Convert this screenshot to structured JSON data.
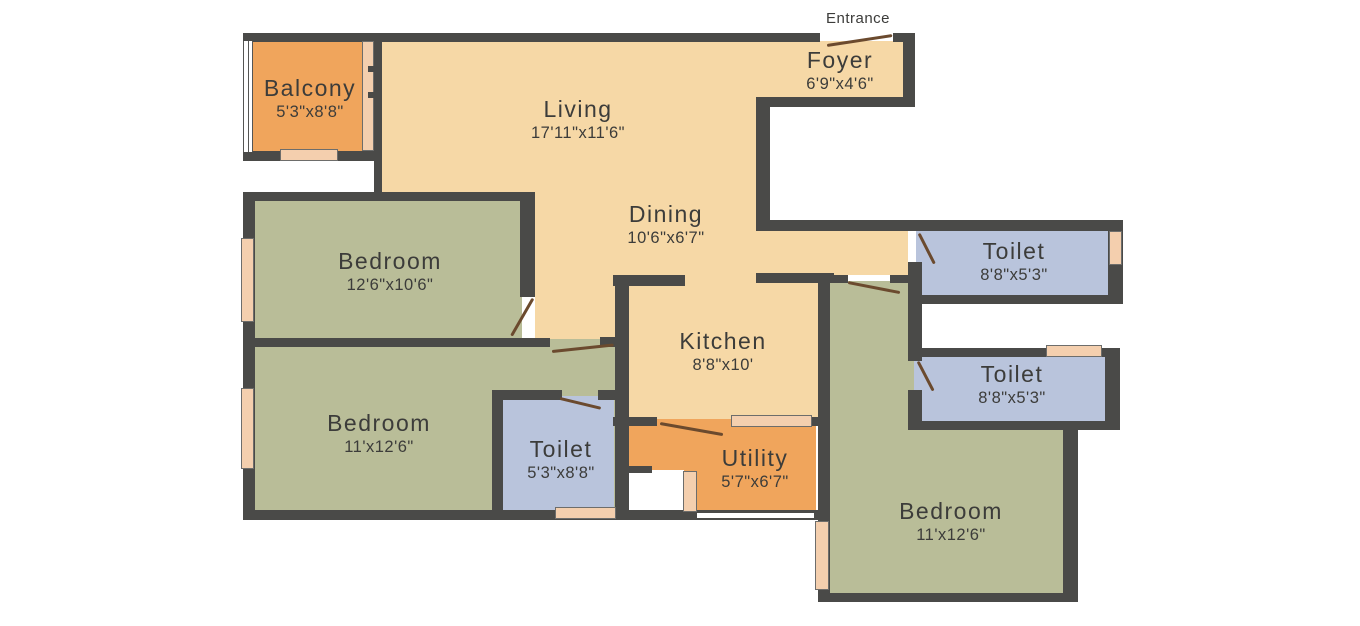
{
  "title": "Apartment 3BHK floor plan",
  "entrance": {
    "label": "Entrance"
  },
  "rooms": [
    {
      "id": "balcony",
      "name": "Balcony",
      "dims": "5'3\"x8'8\""
    },
    {
      "id": "living",
      "name": "Living",
      "dims": "17'11\"x11'6\""
    },
    {
      "id": "foyer",
      "name": "Foyer",
      "dims": "6'9\"x4'6\""
    },
    {
      "id": "dining",
      "name": "Dining",
      "dims": "10'6\"x6'7\""
    },
    {
      "id": "bedroom-1",
      "name": "Bedroom",
      "dims": "12'6\"x10'6\""
    },
    {
      "id": "bedroom-2",
      "name": "Bedroom",
      "dims": "11'x12'6\""
    },
    {
      "id": "toilet-mid",
      "name": "Toilet",
      "dims": "5'3\"x8'8\""
    },
    {
      "id": "kitchen",
      "name": "Kitchen",
      "dims": "8'8\"x10'"
    },
    {
      "id": "utility",
      "name": "Utility",
      "dims": "5'7\"x6'7\""
    },
    {
      "id": "toilet-right-top",
      "name": "Toilet",
      "dims": "8'8\"x5'3\""
    },
    {
      "id": "toilet-right-mid",
      "name": "Toilet",
      "dims": "8'8\"x5'3\""
    },
    {
      "id": "bedroom-3",
      "name": "Bedroom",
      "dims": "11'x12'6\""
    }
  ],
  "palette": {
    "wall": "#4a4a48",
    "floor_living_cream": "#f6d8a6",
    "floor_bedroom_green": "#b9bd98",
    "floor_toilet_blue": "#b9c4dc",
    "floor_balcony_utility_orange": "#f0a55c",
    "window_peach": "#f4cfae",
    "door_swing_brown": "#6b4a2e",
    "text": "#3c3c3a",
    "background": "#ffffff"
  }
}
